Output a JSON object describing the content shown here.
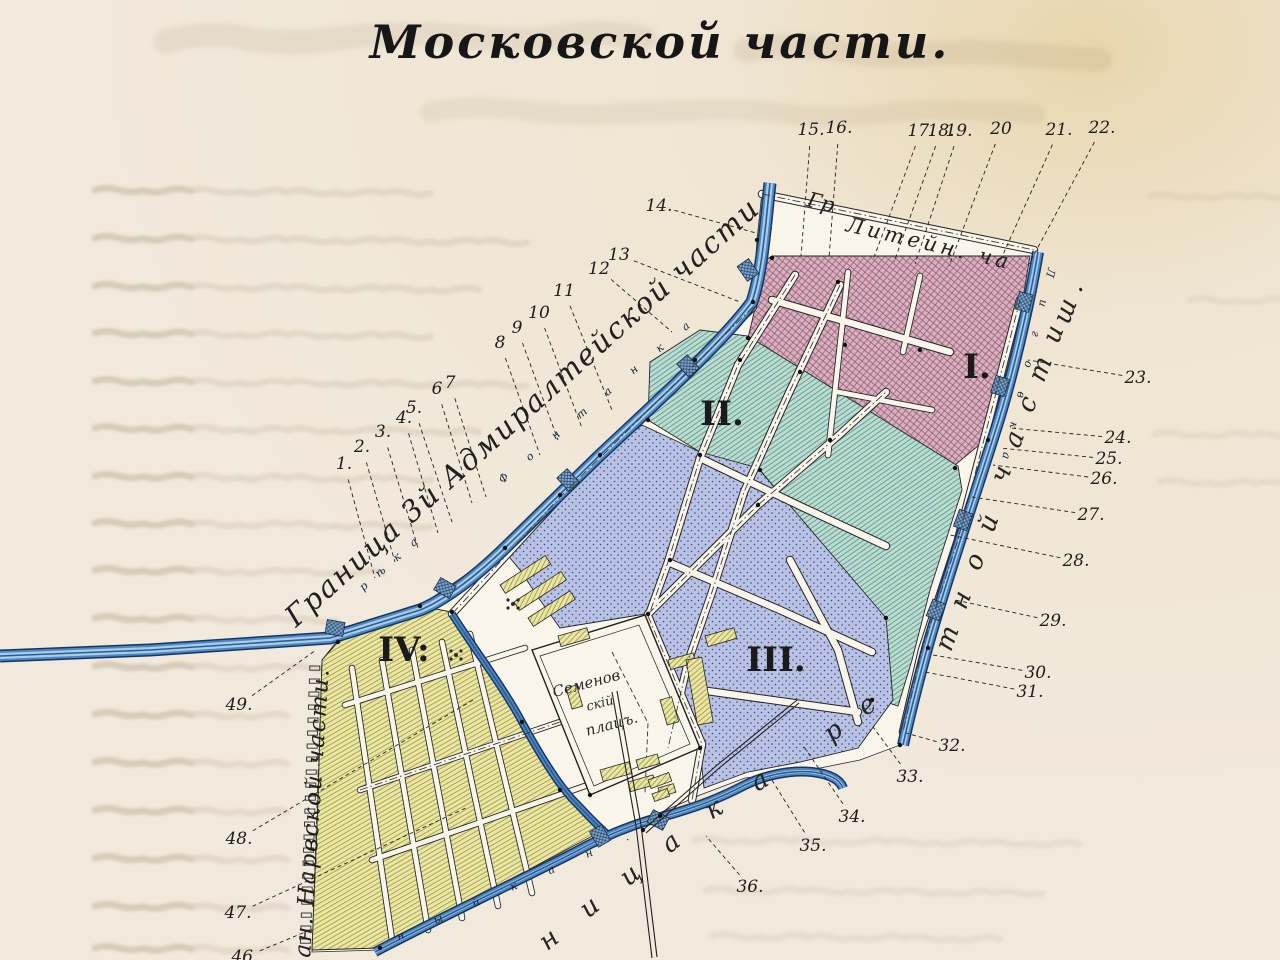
{
  "page": {
    "title": "Московской части."
  },
  "map": {
    "district_labels": [
      "I.",
      "II.",
      "III.",
      "IV:"
    ],
    "boundary_labels": {
      "admiralty": "Граница 3й Адмиралтейской части.",
      "liteinaya_abbr": "Гр",
      "liteinaya": "Литейн. ча",
      "narva": "ан. Нарвской части."
    },
    "letter_runs": {
      "karetnaya_lower": "ница",
      "karetnaya_ka": "ка",
      "karetnaya_re": "ре",
      "karetnaya_upper1": "тной",
      "karetnaya_upper2": "части",
      "karetnaya_upper3": "ш.",
      "fontanka_reka": "рѣка",
      "fontanka_name": "Фонтанка",
      "ligovka": "Лиговка",
      "obvodny": "ный кан."
    },
    "plaza_label": {
      "line1": "Семенов",
      "line2": "скій",
      "line3": "плацъ."
    },
    "reference_numbers": [
      "1.",
      "2.",
      "3.",
      "4.",
      "5.",
      "6",
      "7",
      "8",
      "9",
      "10",
      "11",
      "12",
      "13",
      "14.",
      "15.",
      "16.",
      "17.",
      "18.",
      "19.",
      "20",
      "21.",
      "22.",
      "23.",
      "24.",
      "25.",
      "26.",
      "27.",
      "28.",
      "29.",
      "30.",
      "31.",
      "32.",
      "33.",
      "34.",
      "35.",
      "36.",
      "46.",
      "47.",
      "48.",
      "49."
    ]
  },
  "colors": {
    "paper": "#f1e8da",
    "map_white": "#faf5eb",
    "district_i_fill": "#d8b2c1",
    "district_i_hatch": "#93566f",
    "district_ii_fill": "#bddcd1",
    "district_ii_hatch": "#4f9183",
    "district_iii_fill": "#b9c2e3",
    "district_iii_dots": "#3a4a90",
    "district_iv_fill": "#ebe5a6",
    "district_iv_hatch": "#96953c",
    "water_dark": "#17375e",
    "water_mid": "#4d86c4",
    "water_light": "#a9cde8",
    "ink": "#1d1d1d",
    "ghost": "#a08868"
  }
}
